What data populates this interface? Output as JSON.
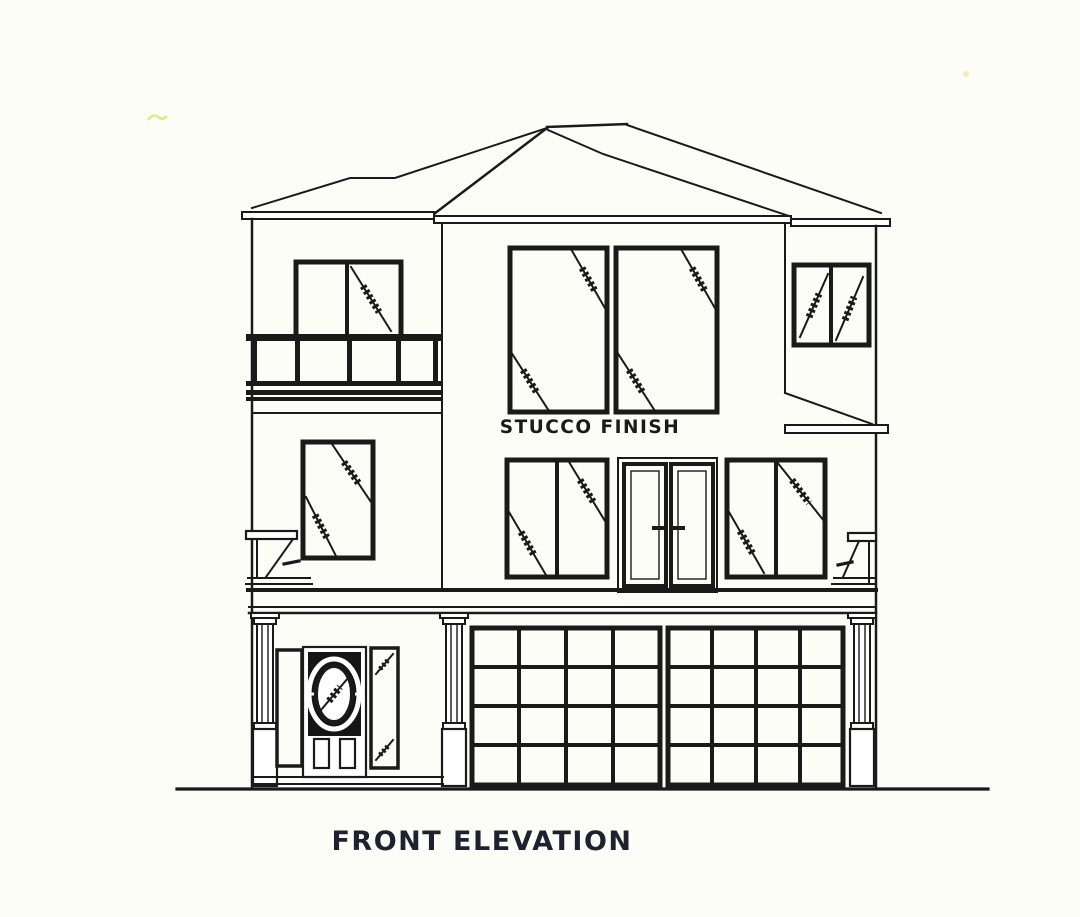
{
  "document": {
    "labels": {
      "material_note": "STUCCO  FINISH",
      "title": "FRONT ELEVATION"
    },
    "colors": {
      "paper": "#fdfdf8",
      "ink": "#1a1a1a",
      "title_ink": "#1d2130",
      "door_fill": "#151515",
      "scan_mark_yellow": "#dfe45a"
    }
  }
}
